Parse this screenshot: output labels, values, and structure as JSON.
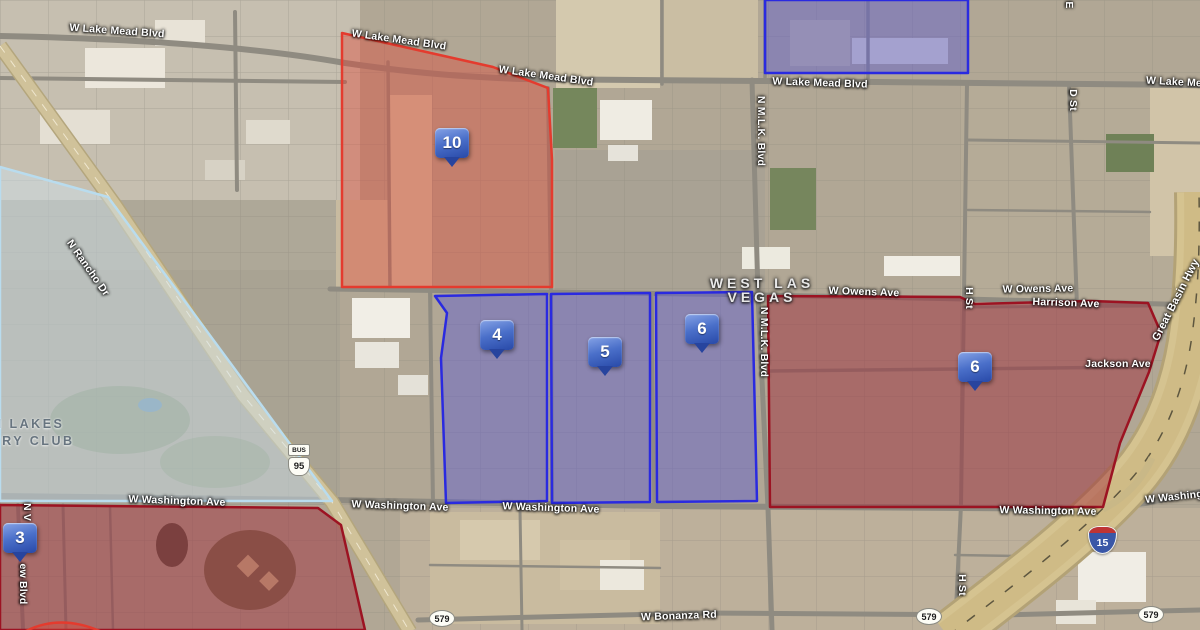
{
  "map_type": "satellite",
  "place_labels": {
    "city_line1": "WEST LAS",
    "city_line2": "VEGAS",
    "country_club_line1": "N LAKES",
    "country_club_line2": "TRY CLUB"
  },
  "street_labels": [
    {
      "text": "W Lake Mead Blvd"
    },
    {
      "text": "W Lake Mead Blvd"
    },
    {
      "text": "W Lake Mead Blvd"
    },
    {
      "text": "W Lake Mead Blvd"
    },
    {
      "text": "W Lake Me"
    },
    {
      "text": "W Owens Ave"
    },
    {
      "text": "W Owens Ave"
    },
    {
      "text": "Harrison Ave"
    },
    {
      "text": "Jackson Ave"
    },
    {
      "text": "W Washington Ave"
    },
    {
      "text": "W Washington Ave"
    },
    {
      "text": "W Washington Ave"
    },
    {
      "text": "W Washington Ave"
    },
    {
      "text": "W Washing"
    },
    {
      "text": "W Bonanza Rd"
    },
    {
      "text": "N Rancho Dr"
    },
    {
      "text": "N M.L.K. Blvd"
    },
    {
      "text": "N M.L.K. Blvd"
    },
    {
      "text": "D St"
    },
    {
      "text": "H St"
    },
    {
      "text": "H St"
    },
    {
      "text": "Great Basin Hwy"
    },
    {
      "text": "E"
    },
    {
      "text": "N V"
    },
    {
      "text": "ew Blvd"
    }
  ],
  "markers": [
    {
      "label": "10"
    },
    {
      "label": "4"
    },
    {
      "label": "5"
    },
    {
      "label": "6"
    },
    {
      "label": "6"
    },
    {
      "label": "3"
    }
  ],
  "shields": {
    "bus_banner": "BUS",
    "bus_route": "95",
    "state_route": "579",
    "interstate": "15"
  },
  "colors": {
    "region_red_fill": "#e04332",
    "region_red_stroke": "#e43b2e",
    "region_blue_fill": "#5656d6",
    "region_blue_stroke": "#2a2ae0",
    "region_darkred_fill": "#9e2433",
    "region_darkred_stroke": "#9c1322",
    "region_lightblue_fill": "#cfe3ef",
    "region_lightblue_stroke": "#b9dcee",
    "marker_gradient_top": "#86a3e6",
    "marker_gradient_bottom": "#2849a8"
  },
  "regions": [
    {
      "marker": "10",
      "style": "red"
    },
    {
      "marker": "4",
      "style": "blue"
    },
    {
      "marker": "5",
      "style": "blue"
    },
    {
      "marker": "6",
      "style": "blue"
    },
    {
      "marker": "6",
      "style": "darkred"
    },
    {
      "marker": "3",
      "style": "darkred"
    },
    {
      "marker": "",
      "style": "blue-top"
    },
    {
      "marker": "",
      "style": "lightblue-west"
    }
  ]
}
